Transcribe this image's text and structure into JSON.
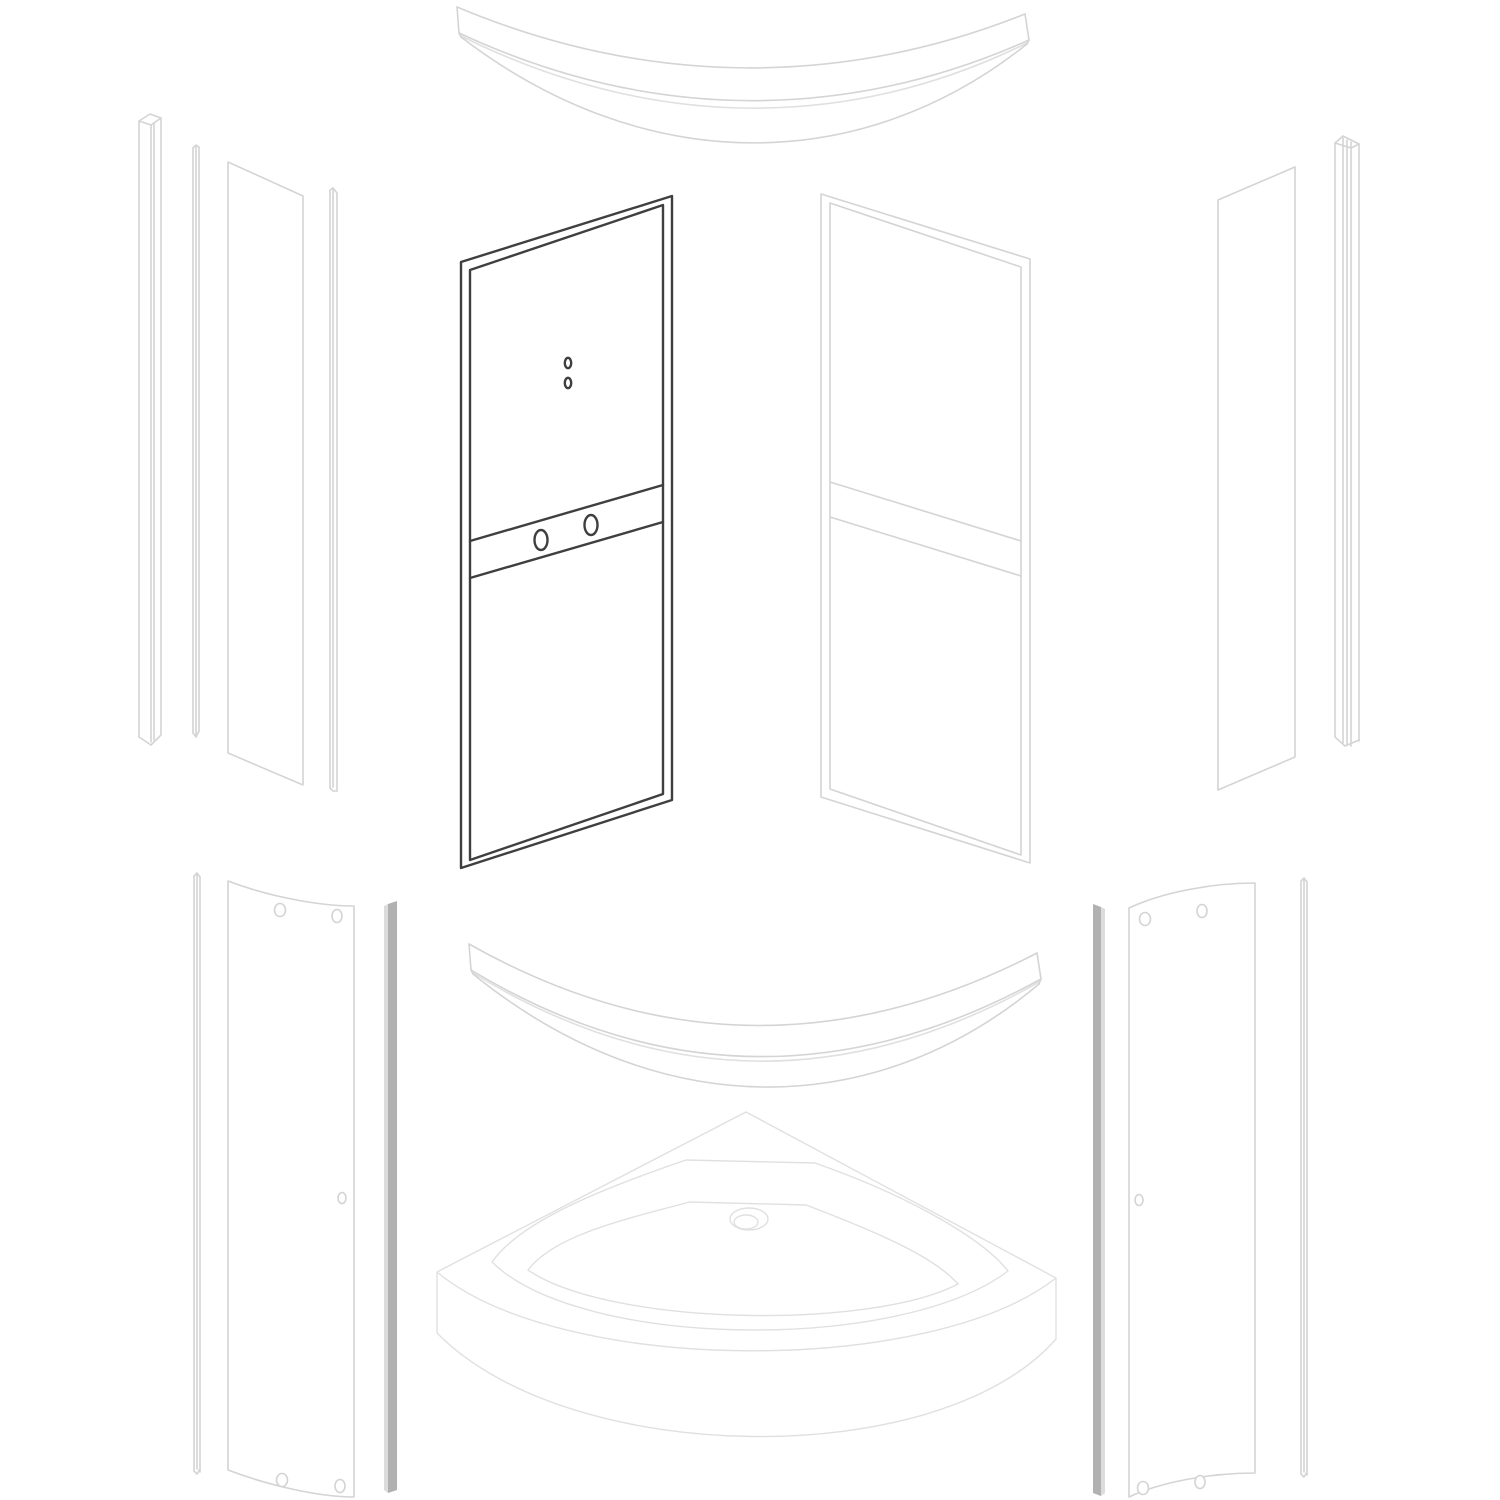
{
  "canvas": {
    "width": 1500,
    "height": 1500,
    "background": "#ffffff"
  },
  "colors": {
    "bg": "#ffffff",
    "line-light": "#d4d4d4",
    "line-faint": "#e0e0e0",
    "line-dark": "#3f3f3f",
    "bar-fill": "#b1b1b1",
    "bar-edge": "#dcdcdc",
    "panel-fill": "#ffffff"
  },
  "diagram": {
    "type": "exploded-parts-diagram",
    "subject": "quadrant shower enclosure",
    "highlighted_part": "framed door panel (left)",
    "highlight_color": "#3f3f3f"
  },
  "parts": [
    {
      "id": "top-curved-rail",
      "name": "top curved rail"
    },
    {
      "id": "left-wall-profile",
      "name": "left wall profile"
    },
    {
      "id": "left-seal-strip",
      "name": "left seal strip"
    },
    {
      "id": "left-side-panel",
      "name": "left fixed side glass panel"
    },
    {
      "id": "left-magnet-strip",
      "name": "left magnet strip"
    },
    {
      "id": "framed-door-panel-left",
      "name": "framed door panel left (highlighted)"
    },
    {
      "id": "framed-door-panel-right",
      "name": "framed door panel right"
    },
    {
      "id": "right-side-panel",
      "name": "right fixed side glass panel"
    },
    {
      "id": "right-wall-profile",
      "name": "right wall profile"
    },
    {
      "id": "bottom-left-seal-strip",
      "name": "bottom left seal strip"
    },
    {
      "id": "bottom-left-curved-glass-panel",
      "name": "bottom left curved glass door panel"
    },
    {
      "id": "bottom-left-handle-bar",
      "name": "bottom left handle bar"
    },
    {
      "id": "bottom-curved-rail",
      "name": "bottom curved rail"
    },
    {
      "id": "shower-tray",
      "name": "quadrant shower tray with drain"
    },
    {
      "id": "bottom-right-handle-bar",
      "name": "bottom right handle bar"
    },
    {
      "id": "bottom-right-curved-glass-panel",
      "name": "bottom right curved glass door panel"
    },
    {
      "id": "bottom-right-seal-strip",
      "name": "bottom right seal strip"
    }
  ]
}
